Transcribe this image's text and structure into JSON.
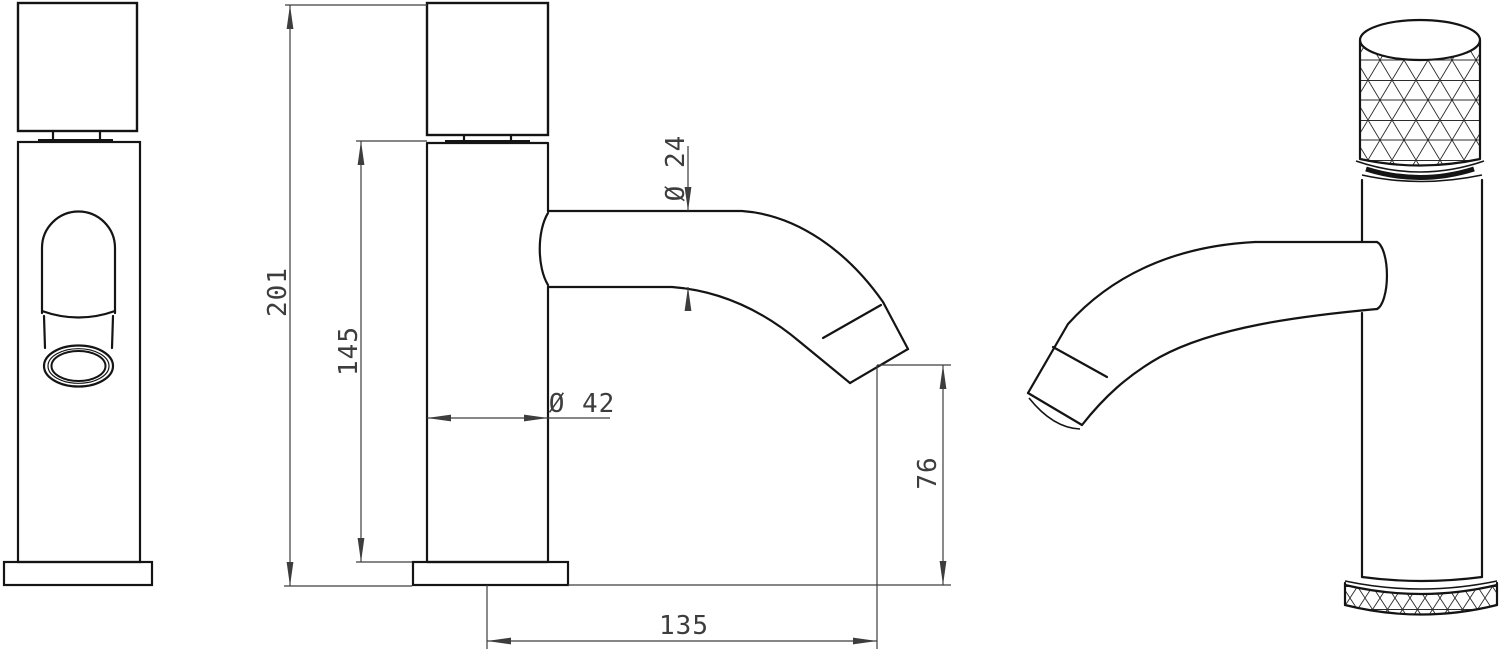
{
  "page": {
    "background_color": "#ffffff",
    "object_line_color": "#141414",
    "dimension_line_color": "#3d3d3d"
  },
  "drawing": {
    "subject": "single-lever basin faucet technical drawing, three views",
    "dimensions": {
      "overall_height": {
        "label": "201"
      },
      "body_height": {
        "label": "145"
      },
      "spout_tube_diameter": {
        "label": "Ø 24"
      },
      "body_diameter": {
        "label": "Ø 42"
      },
      "spout_outlet_height": {
        "label": "76"
      },
      "spout_reach": {
        "label": "135"
      }
    }
  }
}
